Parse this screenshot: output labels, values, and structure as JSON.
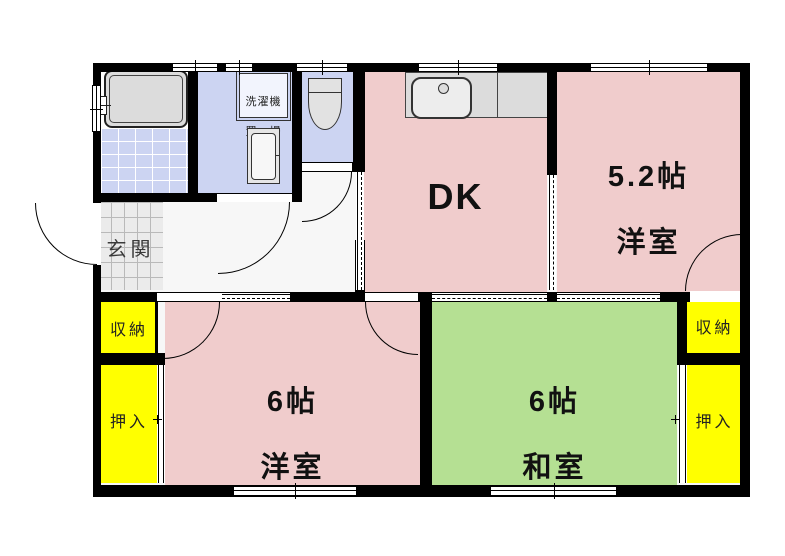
{
  "rooms": {
    "dk": {
      "label": "DK"
    },
    "western_5_2": {
      "size": "5.2帖",
      "type": "洋室"
    },
    "western_6": {
      "size": "6帖",
      "type": "洋室"
    },
    "japanese_6": {
      "size": "6帖",
      "type": "和室"
    },
    "entrance": {
      "label": "玄関"
    },
    "laundry": {
      "line1": "洗濯機",
      "line2": "置　場"
    }
  },
  "storage": {
    "left_upper": "収納",
    "left_lower": "押入",
    "right_upper": "収納",
    "right_lower": "押入"
  },
  "icons": {
    "bathtub": "rounded-rect-shape",
    "toilet": "tank-and-bowl-shape",
    "washbasin": "cabinet-shape",
    "kitchen_sink": "counter-with-sink-shape",
    "door_arc": "quarter-circle",
    "window": "double-line-gap",
    "sliding_door": "dashed-line-gap"
  },
  "colors": {
    "room_pink": "#f0cccc",
    "tatami_green": "#b5e093",
    "storage_yellow": "#ffff00",
    "wet_area_blue": "#ccd4f2",
    "fixture_grey": "#dcdcdc",
    "entrance_tile_grey": "#ebebeb",
    "wall_black": "#000000"
  }
}
